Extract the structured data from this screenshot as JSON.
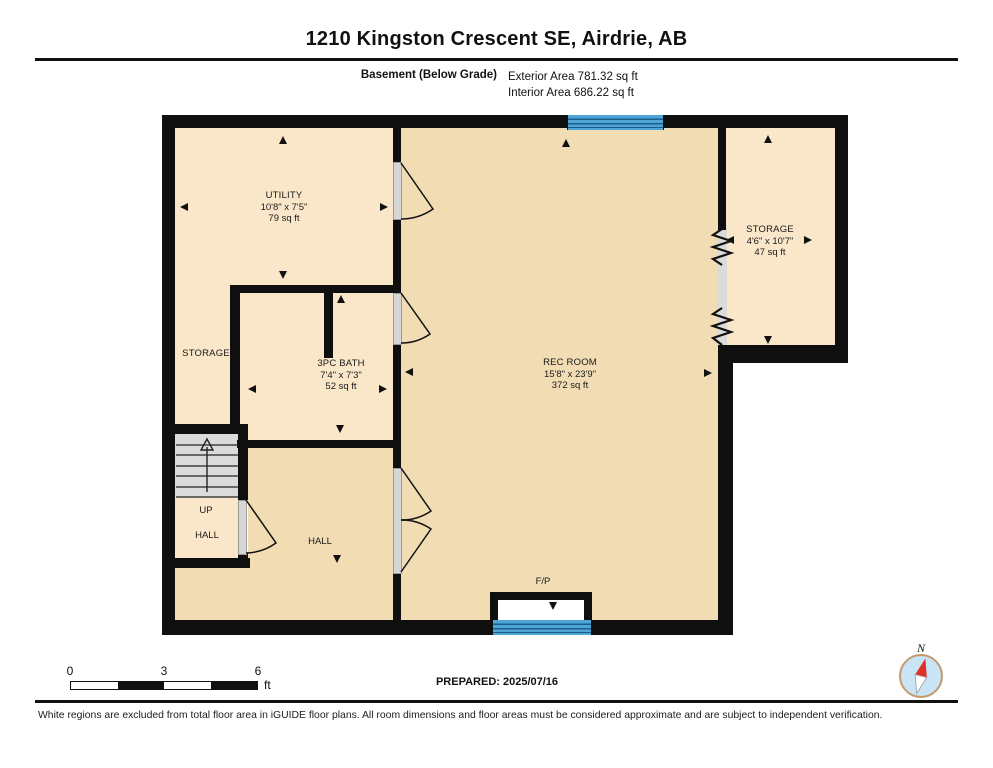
{
  "header": {
    "title": "1210 Kingston Crescent SE, Airdrie, AB",
    "floor_label": "Basement (Below Grade)",
    "exterior_area": "Exterior Area 781.32 sq ft",
    "interior_area": "Interior Area 686.22 sq ft"
  },
  "rooms": {
    "utility": {
      "name": "UTILITY",
      "dims": "10'8\" x 7'5\"",
      "area": "79 sq ft"
    },
    "storage_left": {
      "name": "STORAGE"
    },
    "bath": {
      "name": "3PC BATH",
      "dims": "7'4\" x 7'3\"",
      "area": "52 sq ft"
    },
    "rec_room": {
      "name": "REC ROOM",
      "dims": "15'8\" x 23'9\"",
      "area": "372 sq ft"
    },
    "storage_right": {
      "name": "STORAGE",
      "dims": "4'6\" x 10'7\"",
      "area": "47 sq ft"
    },
    "hall_main": {
      "name": "HALL"
    },
    "stair_hall": {
      "up": "UP",
      "name": "HALL"
    },
    "fireplace": {
      "label": "F/P"
    }
  },
  "footer": {
    "scale": {
      "t0": "0",
      "t3": "3",
      "t6": "6",
      "unit": "ft"
    },
    "prepared": "PREPARED: 2025/07/16",
    "compass_north": "N",
    "disclaimer": "White regions are excluded from total floor area in iGUIDE floor plans. All room dimensions and floor areas must be considered approximate and are subject to independent verification."
  },
  "colors": {
    "wall": "#0f0f0f",
    "room_light": "#fae7c9",
    "room_dark": "#f1dcb4",
    "window_blue": "#4fa5d5",
    "stairs_gray": "#dbdbdb",
    "compass_red": "#e03127"
  }
}
